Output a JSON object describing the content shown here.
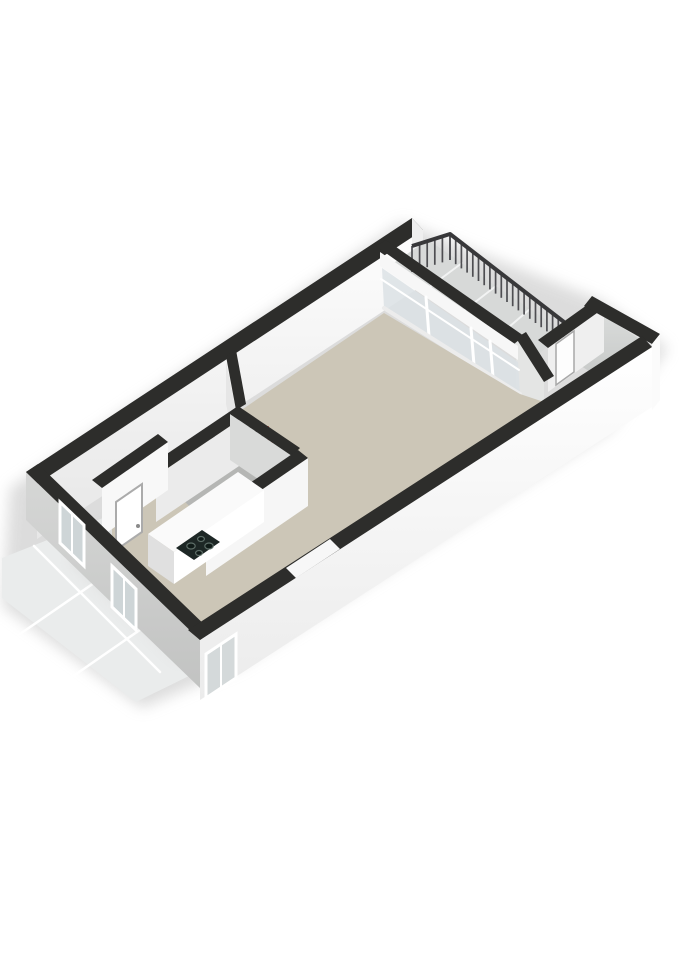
{
  "meta": {
    "description": "3D isometric floor plan of a studio apartment with balcony, storage room, bathroom, kitchen corner and entrance walkway",
    "background_color": "#ffffff",
    "wall_top_color": "#2d2d2b",
    "floor_beige": "#ccc6b7",
    "floor_bathroom": "#b5b6b4",
    "floor_balcony": "#d7d9d8",
    "floor_storage": "#d5d7d6",
    "walkway_tile": "#eaecec",
    "accent_pipe_red": "#b23c2e"
  },
  "scene": {
    "width": 679,
    "height": 960,
    "items": [
      {
        "name": "ground-shadow",
        "type": "polygon",
        "pts": "10,488 402,222 600,300 668,348 610,430 240,666 142,708 2,606",
        "fill": "#d9d9d9",
        "op": 0.9,
        "blur": true
      },
      {
        "name": "walkway-tiles",
        "type": "polygon",
        "pts": "2,558 108,516 246,648 136,702 2,598",
        "fill": "#eaecec"
      },
      {
        "name": "walkway-grout-line",
        "type": "line",
        "x1": 34,
        "y1": 546,
        "x2": 160,
        "y2": 672,
        "stroke": "#ffffff",
        "sw": 2.5
      },
      {
        "name": "walkway-grout-line",
        "type": "line",
        "x1": 78,
        "y1": 528,
        "x2": 204,
        "y2": 654,
        "stroke": "#ffffff",
        "sw": 2.5
      },
      {
        "name": "walkway-grout-line",
        "type": "line",
        "x1": 20,
        "y1": 634,
        "x2": 168,
        "y2": 532,
        "stroke": "#ffffff",
        "sw": 2.5
      },
      {
        "name": "walkway-grout-line",
        "type": "line",
        "x1": 56,
        "y1": 688,
        "x2": 212,
        "y2": 580,
        "stroke": "#ffffff",
        "sw": 2.5
      },
      {
        "name": "walkway-shade",
        "type": "polygon",
        "pts": "108,516 246,648 180,660 70,560",
        "fill": "#c9cbca",
        "op": 0.45,
        "blur": true
      },
      {
        "name": "top-wall-inner-face",
        "type": "polygon",
        "pts": "37,484 423,230 423,285 37,539",
        "fill": "url(#gA)"
      },
      {
        "name": "top-wall-top-band",
        "type": "polygon",
        "pts": "26,472 412,218 423,230 37,484",
        "fill": "#2d2d2b"
      },
      {
        "name": "top-wall-end-cap",
        "type": "polygon",
        "pts": "412,218 423,230 423,285 412,274",
        "fill": "#efefef"
      },
      {
        "name": "balcony-floor",
        "type": "polygon",
        "pts": "392,264 428,240 564,332 530,362",
        "fill": "#d7d9d8"
      },
      {
        "name": "balcony-tile-joint",
        "type": "line",
        "x1": 462,
        "y1": 263,
        "x2": 427,
        "y2": 289,
        "stroke": "#f2f3f3",
        "sw": 2
      },
      {
        "name": "balcony-tile-joint",
        "type": "line",
        "x1": 496,
        "y1": 286,
        "x2": 461,
        "y2": 313,
        "stroke": "#f2f3f3",
        "sw": 2
      },
      {
        "name": "balcony-tile-joint",
        "type": "line",
        "x1": 530,
        "y1": 309,
        "x2": 496,
        "y2": 338,
        "stroke": "#f2f3f3",
        "sw": 2
      },
      {
        "name": "balcony-railing",
        "type": "railing",
        "top": [
          [
            412,
            246
          ],
          [
            450,
            234
          ],
          [
            564,
            322
          ]
        ],
        "drops": [
          26,
          26,
          22
        ],
        "counts": [
          5,
          20
        ],
        "rail_stroke": "#38383a",
        "rail_w": 4,
        "bal_stroke": "#4e4e52",
        "bal_w": 1.7
      },
      {
        "name": "storage-floor",
        "type": "polygon",
        "pts": "556,350 598,312 644,342 606,382",
        "fill": "url(#gD)"
      },
      {
        "name": "storage-divider-face",
        "type": "polygon",
        "pts": "548,348 604,308 604,352 548,392",
        "fill": "#efefef"
      },
      {
        "name": "storage-door",
        "type": "polygon",
        "pts": "556,344 574,331 574,372 556,385",
        "fill": "#fdfdfd",
        "stroke": "#a8a8a8",
        "sw": 1.5
      },
      {
        "name": "storage-divider-band",
        "type": "polygon",
        "pts": "538,340 594,300 604,308 548,348",
        "fill": "#2d2d2b"
      },
      {
        "name": "storage-end-wall-band",
        "type": "polygon",
        "pts": "592,296 660,334 652,344 584,306",
        "fill": "#2d2d2b"
      },
      {
        "name": "storage-exterior-face",
        "type": "polygon",
        "pts": "652,344 660,334 660,400 652,410",
        "fill": "#fbfbfb"
      },
      {
        "name": "storage-side-wall-face",
        "type": "polygon",
        "pts": "516,338 544,382 544,430 516,386",
        "fill": "#e4e5e4"
      },
      {
        "name": "storage-side-wall-band",
        "type": "polygon",
        "pts": "516,338 544,382 554,376 526,332",
        "fill": "#2d2d2b"
      },
      {
        "name": "glass-wall-band",
        "type": "polygon",
        "pts": "376,246 386,240 524,336 514,344",
        "fill": "#2d2d2b"
      },
      {
        "name": "glass-wall-transom",
        "type": "polygon",
        "pts": "380,252 518,346 518,360 380,266",
        "fill": "#f7f7f7"
      },
      {
        "name": "glass-wall-glazing",
        "type": "polygon",
        "pts": "382,268 518,362 520,394 384,308",
        "fill": "#dce2e5",
        "op": 0.85
      },
      {
        "name": "glass-wall-rail",
        "type": "line",
        "x1": 381,
        "y1": 279,
        "x2": 519,
        "y2": 370,
        "stroke": "#ffffff",
        "sw": 2
      },
      {
        "name": "glass-wall-mullion",
        "type": "line",
        "x1": 426,
        "y1": 297,
        "x2": 429,
        "y2": 336,
        "stroke": "#ffffff",
        "sw": 3
      },
      {
        "name": "glass-wall-mullion",
        "type": "line",
        "x1": 471,
        "y1": 328,
        "x2": 474,
        "y2": 365,
        "stroke": "#ffffff",
        "sw": 3
      },
      {
        "name": "glass-wall-mullion",
        "type": "line",
        "x1": 490,
        "y1": 341,
        "x2": 493,
        "y2": 377,
        "stroke": "#ffffff",
        "sw": 3
      },
      {
        "name": "glass-wall-sill",
        "type": "line",
        "x1": 384,
        "y1": 308,
        "x2": 520,
        "y2": 394,
        "stroke": "#ececec",
        "sw": 4
      },
      {
        "name": "living-room-floor",
        "type": "polygon",
        "pts": "112,498 384,313 520,394 544,402 192,630 112,540",
        "fill": "#ccc6b7"
      },
      {
        "name": "living-room-door-leaf",
        "type": "polygon",
        "pts": "310,582 314,552 326,546 330,576",
        "fill": "#fefefe",
        "stroke": "#c8c8c8",
        "sw": 1
      },
      {
        "name": "hall-stub-wall-face",
        "type": "polygon",
        "pts": "226,362 236,410 236,452 226,404",
        "fill": "#e6e6e6"
      },
      {
        "name": "hall-stub-wall-band",
        "type": "polygon",
        "pts": "226,356 236,350 246,404 236,410",
        "fill": "#2d2d2b"
      },
      {
        "name": "bathroom-floor",
        "type": "polygon",
        "pts": "160,478 242,420 288,452 206,522",
        "fill": "#b5b6b4"
      },
      {
        "name": "tech-closet-floor",
        "type": "polygon",
        "pts": "242,420 288,452 262,472 218,440",
        "fill": "#c0c2c1"
      },
      {
        "name": "tech-closet-divider-band",
        "type": "polygon",
        "pts": "214,436 262,470 256,476 208,442",
        "fill": "#2d2d2b"
      },
      {
        "name": "heating-pipe",
        "type": "line",
        "x1": 250,
        "y1": 446,
        "x2": 250,
        "y2": 428,
        "stroke": "#202020",
        "sw": 2
      },
      {
        "name": "heating-pipe",
        "type": "line",
        "x1": 256,
        "y1": 448,
        "x2": 256,
        "y2": 430,
        "stroke": "#202020",
        "sw": 2
      },
      {
        "name": "heating-pipe",
        "type": "line",
        "x1": 262,
        "y1": 444,
        "x2": 262,
        "y2": 426,
        "stroke": "#202020",
        "sw": 2
      },
      {
        "name": "heating-pipe-red",
        "type": "line",
        "x1": 268,
        "y1": 443,
        "x2": 268,
        "y2": 427,
        "stroke": "#b23c2e",
        "sw": 2
      },
      {
        "name": "heating-pipe-red",
        "type": "line",
        "x1": 272,
        "y1": 445,
        "x2": 272,
        "y2": 431,
        "stroke": "#c2412f",
        "sw": 1.6
      },
      {
        "name": "bathroom-nw-wall-face",
        "type": "polygon",
        "pts": "156,476 248,414 248,460 156,522",
        "fill": "#ebebeb"
      },
      {
        "name": "bathroom-nw-wall-band",
        "type": "polygon",
        "pts": "146,468 238,406 248,414 156,476",
        "fill": "#2d2d2b"
      },
      {
        "name": "bathroom-ne-wall-face",
        "type": "polygon",
        "pts": "230,414 292,456 292,502 230,460",
        "fill": "#d9dad9"
      },
      {
        "name": "bathroom-ne-wall-band",
        "type": "polygon",
        "pts": "238,406 300,448 292,456 230,414",
        "fill": "#2d2d2b"
      },
      {
        "name": "bathroom-se-wall-face",
        "type": "polygon",
        "pts": "206,528 308,458 308,506 206,576",
        "fill": "#f6f6f6"
      },
      {
        "name": "bathroom-se-wall-band",
        "type": "polygon",
        "pts": "196,520 298,450 308,458 206,528",
        "fill": "#2d2d2b"
      },
      {
        "name": "kitchen-counter-top",
        "type": "polygon",
        "pts": "148,534 238,472 264,490 174,552",
        "fill": "#fafafa"
      },
      {
        "name": "kitchen-counter-front",
        "type": "polygon",
        "pts": "174,552 264,490 264,522 174,584",
        "fill": "#ffffff"
      },
      {
        "name": "kitchen-counter-side",
        "type": "polygon",
        "pts": "148,534 174,552 174,584 148,566",
        "fill": "#e0e0e0"
      },
      {
        "name": "cooktop",
        "type": "polygon",
        "pts": "176,548 202,530 220,542 194,560",
        "fill": "#1d2725"
      },
      {
        "name": "cooktop-burner",
        "type": "ellipse",
        "cx": 191,
        "cy": 546,
        "rx": 4.2,
        "ry": 3,
        "fill": "#101b18",
        "stroke": "#5d6d67",
        "sw": 1.2
      },
      {
        "name": "cooktop-burner",
        "type": "ellipse",
        "cx": 201,
        "cy": 539,
        "rx": 3.4,
        "ry": 2.5,
        "fill": "#101b18",
        "stroke": "#5d6d67",
        "sw": 1.2
      },
      {
        "name": "cooktop-burner",
        "type": "ellipse",
        "cx": 199,
        "cy": 553,
        "rx": 3.4,
        "ry": 2.5,
        "fill": "#101b18",
        "stroke": "#5d6d67",
        "sw": 1.2
      },
      {
        "name": "cooktop-burner",
        "type": "ellipse",
        "cx": 209,
        "cy": 546,
        "rx": 4.2,
        "ry": 3,
        "fill": "#101b18",
        "stroke": "#5d6d67",
        "sw": 1.2
      },
      {
        "name": "entrance-wall-face",
        "type": "polygon",
        "pts": "102,488 168,442 168,490 102,536",
        "fill": "#f8f8f8"
      },
      {
        "name": "entrance-wall-band",
        "type": "polygon",
        "pts": "92,480 158,434 168,442 102,488",
        "fill": "#2d2d2b"
      },
      {
        "name": "front-door",
        "type": "polygon",
        "pts": "116,502 142,484 142,532 116,550",
        "fill": "#ffffff",
        "stroke": "#ababab",
        "sw": 2
      },
      {
        "name": "front-door-handle",
        "type": "ellipse",
        "cx": 138,
        "cy": 526,
        "rx": 2,
        "ry": 2,
        "fill": "#8a8a8a"
      },
      {
        "name": "end-wall-exterior-face",
        "type": "polygon",
        "pts": "26,472 200,640 200,688 26,520",
        "fill": "url(#gC)"
      },
      {
        "name": "end-wall-band",
        "type": "polygon",
        "pts": "26,472 200,640 212,632 38,464",
        "fill": "#2d2d2b"
      },
      {
        "name": "end-wall-window-glass",
        "type": "polygon",
        "pts": "60,502 84,525 84,566 60,543",
        "fill": "#ced5d7",
        "stroke": "#ffffff",
        "sw": 3
      },
      {
        "name": "end-wall-window-mullion",
        "type": "line",
        "x1": 72,
        "y1": 514,
        "x2": 72,
        "y2": 555,
        "stroke": "#ffffff",
        "sw": 2
      },
      {
        "name": "end-wall-window2-glass",
        "type": "polygon",
        "pts": "112,566 136,589 136,630 112,607",
        "fill": "#ced5d7",
        "stroke": "#ffffff",
        "sw": 3
      },
      {
        "name": "end-wall-window2-mullion",
        "type": "line",
        "x1": 124,
        "y1": 578,
        "x2": 124,
        "y2": 619,
        "stroke": "#ffffff",
        "sw": 2
      },
      {
        "name": "south-wall-exterior-face",
        "type": "polygon",
        "pts": "200,640 652,347 652,407 200,700",
        "fill": "url(#gB)"
      },
      {
        "name": "south-wall-band",
        "type": "polygon",
        "pts": "188,630 642,336 652,347 200,640",
        "fill": "#2d2d2b"
      },
      {
        "name": "south-wall-door-opening",
        "type": "polygon",
        "pts": "296,578 340,549 330,539 286,568",
        "fill": "#f7f7f7"
      },
      {
        "name": "south-wall-window-glass",
        "type": "polygon",
        "pts": "206,654 236,634 236,678 206,698",
        "fill": "#d4d9da",
        "stroke": "#ffffff",
        "sw": 3
      },
      {
        "name": "south-wall-window-mullion",
        "type": "line",
        "x1": 221,
        "y1": 644,
        "x2": 221,
        "y2": 688,
        "stroke": "#ffffff",
        "sw": 2
      }
    ]
  }
}
